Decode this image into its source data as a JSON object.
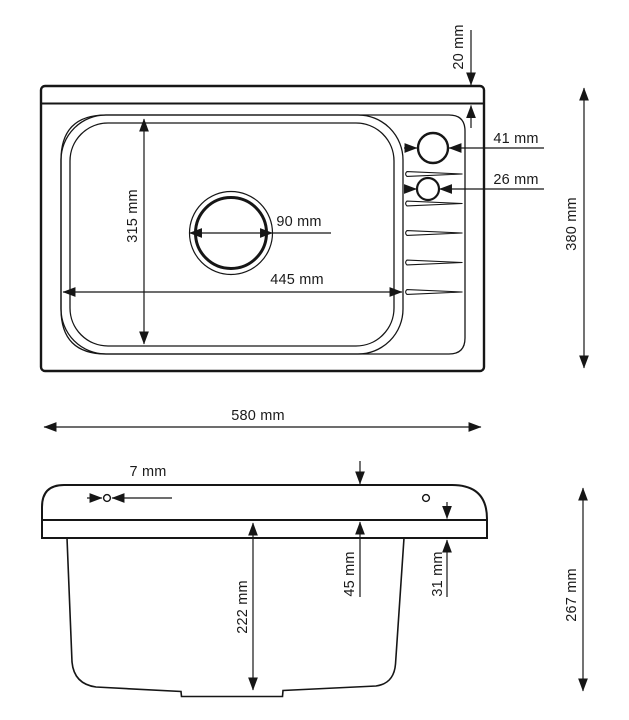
{
  "top_view": {
    "back_ledge_depth": "20 mm",
    "faucet_hole_large_diameter": "41 mm",
    "faucet_hole_small_diameter": "26 mm",
    "drain_hole_diameter": "90 mm",
    "bowl_length": "445 mm",
    "bowl_width": "315 mm",
    "overall_depth": "380 mm",
    "overall_width": "580 mm"
  },
  "side_view": {
    "mounting_hole_diameter": "7 mm",
    "rim_height": "45 mm",
    "apron_height": "31 mm",
    "bowl_height": "222 mm",
    "overall_height": "267 mm"
  }
}
